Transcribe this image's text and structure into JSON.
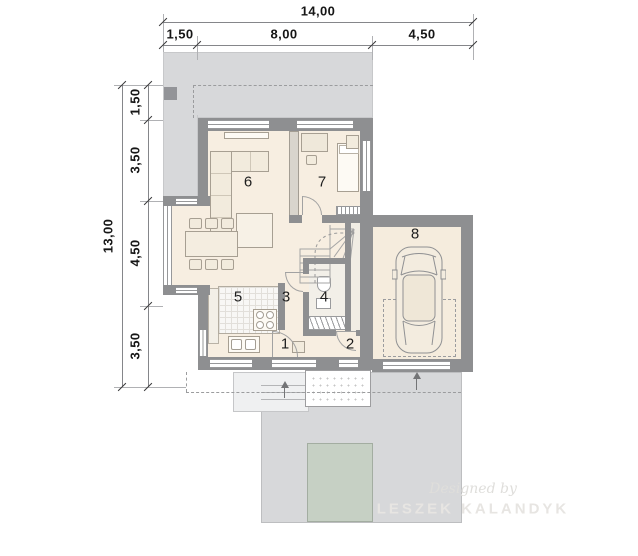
{
  "dimensions": {
    "top": {
      "total": "14,00",
      "segments": [
        "1,50",
        "8,00",
        "4,50"
      ]
    },
    "left": {
      "total": "13,00",
      "segments": [
        "1,50",
        "3,50",
        "4,50",
        "3,50"
      ]
    }
  },
  "rooms": [
    {
      "number": "1"
    },
    {
      "number": "2"
    },
    {
      "number": "3"
    },
    {
      "number": "4"
    },
    {
      "number": "5"
    },
    {
      "number": "6"
    },
    {
      "number": "7"
    },
    {
      "number": "8"
    }
  ],
  "watermark": {
    "line1": "Designed by",
    "line2": "LESZEK KALANDYK"
  },
  "colors": {
    "wall": "#8e8f91",
    "floor": "#f7eee1",
    "terrace": "#d7d8da",
    "driveway": "#d7d8da",
    "lawn": "#c6d0c4",
    "dimension_text": "#161616"
  }
}
